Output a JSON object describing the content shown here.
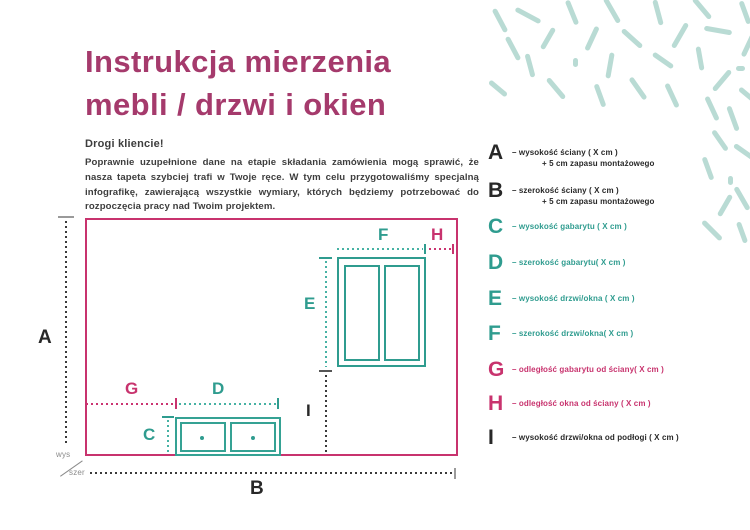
{
  "title": {
    "line1": "Instrukcja mierzenia",
    "line2": "mebli / drzwi i okien"
  },
  "intro": {
    "greeting": "Drogi kliencie!",
    "body": "Poprawnie uzupełnione dane na etapie składania zamówienia mogą sprawić, że nasza tapeta szybciej trafi w Twoje ręce. W tym celu przygotowaliśmy specjalną infografikę, zawierającą wszystkie wymiary, których będziemy potrzebować do rozpoczęcia pracy nad Twoim projektem."
  },
  "diagram": {
    "labels": {
      "A": "A",
      "B": "B",
      "C": "C",
      "D": "D",
      "E": "E",
      "F": "F",
      "G": "G",
      "H": "H",
      "I": "I"
    },
    "axis": {
      "vertical": "wys",
      "horizontal": "szer"
    }
  },
  "legend": {
    "items": [
      {
        "letter": "A",
        "color": "dark",
        "text": "– wysokość ściany  ( X cm )",
        "text2": "+ 5 cm zapasu montażowego"
      },
      {
        "letter": "B",
        "color": "dark",
        "text": "– szerokość ściany  ( X cm )",
        "text2": "+ 5 cm zapasu montażowego"
      },
      {
        "letter": "C",
        "color": "teal",
        "text": "– wysokość gabarytu ( X cm )"
      },
      {
        "letter": "D",
        "color": "teal",
        "text": "– szerokość gabarytu( X cm )"
      },
      {
        "letter": "E",
        "color": "teal",
        "text": "– wysokość drzwi/okna ( X cm )"
      },
      {
        "letter": "F",
        "color": "teal",
        "text": "– szerokość drzwi/okna( X cm )"
      },
      {
        "letter": "G",
        "color": "magenta",
        "text": "– odległość gabarytu od ściany( X cm )"
      },
      {
        "letter": "H",
        "color": "magenta",
        "text": "– odległość okna od ściany ( X cm )"
      },
      {
        "letter": "I",
        "color": "dark",
        "text": "– wysokość drzwi/okna od podłogi ( X cm )"
      }
    ]
  },
  "colors": {
    "title": "#a53a6c",
    "magenta": "#c8336e",
    "teal": "#2f9c8f",
    "teal_dotted": "#47b2a4",
    "mint_decor": "#b9dbd4",
    "text_dark": "#3d3d3d",
    "gray": "#9a9a9a"
  },
  "decor": {
    "dashes": [
      {
        "x": 500,
        "y": 20,
        "l": 26,
        "a": 62
      },
      {
        "x": 513,
        "y": 48,
        "l": 26,
        "a": 62
      },
      {
        "x": 498,
        "y": 88,
        "l": 22,
        "a": 40
      },
      {
        "x": 528,
        "y": 15,
        "l": 28,
        "a": 28
      },
      {
        "x": 548,
        "y": 38,
        "l": 24,
        "a": 120
      },
      {
        "x": 530,
        "y": 65,
        "l": 24,
        "a": 75
      },
      {
        "x": 556,
        "y": 88,
        "l": 26,
        "a": 50
      },
      {
        "x": 572,
        "y": 12,
        "l": 26,
        "a": 68
      },
      {
        "x": 592,
        "y": 38,
        "l": 26,
        "a": 115
      },
      {
        "x": 575,
        "y": 62,
        "l": 9,
        "a": 90
      },
      {
        "x": 612,
        "y": 10,
        "l": 28,
        "a": 60
      },
      {
        "x": 632,
        "y": 38,
        "l": 26,
        "a": 42
      },
      {
        "x": 610,
        "y": 65,
        "l": 26,
        "a": 100
      },
      {
        "x": 600,
        "y": 95,
        "l": 24,
        "a": 70
      },
      {
        "x": 638,
        "y": 88,
        "l": 26,
        "a": 55
      },
      {
        "x": 658,
        "y": 12,
        "l": 26,
        "a": 75
      },
      {
        "x": 680,
        "y": 35,
        "l": 28,
        "a": 120
      },
      {
        "x": 663,
        "y": 60,
        "l": 24,
        "a": 35
      },
      {
        "x": 672,
        "y": 95,
        "l": 26,
        "a": 65
      },
      {
        "x": 702,
        "y": 8,
        "l": 26,
        "a": 50
      },
      {
        "x": 718,
        "y": 30,
        "l": 28,
        "a": 10
      },
      {
        "x": 700,
        "y": 58,
        "l": 24,
        "a": 80
      },
      {
        "x": 722,
        "y": 80,
        "l": 26,
        "a": 130
      },
      {
        "x": 745,
        "y": 12,
        "l": 24,
        "a": 70
      },
      {
        "x": 748,
        "y": 45,
        "l": 24,
        "a": 115
      },
      {
        "x": 740,
        "y": 68,
        "l": 9,
        "a": 0
      },
      {
        "x": 712,
        "y": 108,
        "l": 26,
        "a": 65
      },
      {
        "x": 733,
        "y": 118,
        "l": 26,
        "a": 70
      },
      {
        "x": 748,
        "y": 95,
        "l": 22,
        "a": 40
      },
      {
        "x": 720,
        "y": 140,
        "l": 24,
        "a": 55
      },
      {
        "x": 745,
        "y": 152,
        "l": 26,
        "a": 35
      },
      {
        "x": 708,
        "y": 168,
        "l": 24,
        "a": 70
      },
      {
        "x": 730,
        "y": 180,
        "l": 9,
        "a": 90
      },
      {
        "x": 742,
        "y": 198,
        "l": 26,
        "a": 60
      },
      {
        "x": 725,
        "y": 205,
        "l": 24,
        "a": 120
      },
      {
        "x": 712,
        "y": 230,
        "l": 26,
        "a": 45
      },
      {
        "x": 742,
        "y": 232,
        "l": 22,
        "a": 70
      }
    ]
  }
}
